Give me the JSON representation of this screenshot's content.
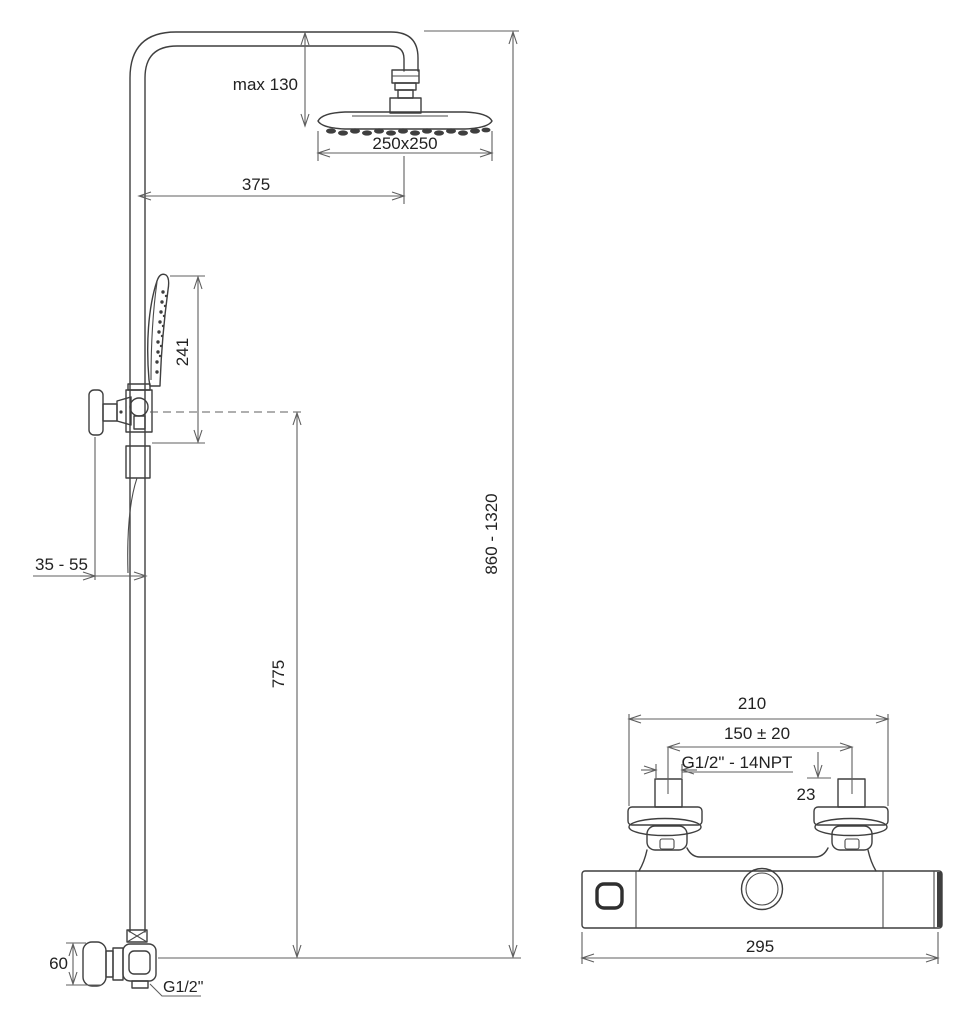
{
  "figure": {
    "type": "technical-installation-drawing",
    "subject": "thermostatic shower column with overhead shower, hand shower and wall mixer",
    "units": "mm",
    "colors": {
      "line": "#3f3f3f",
      "dimension": "#5f5f5f",
      "text": "#222222",
      "background": "#ffffff"
    }
  },
  "shower_column": {
    "max_head_offset": "max 130",
    "head_size": "250x250",
    "arm_reach": "375",
    "hand_shower_length": "241",
    "wall_distance": "35 - 55",
    "hand_shower_outlet_height": "775",
    "column_height_range": "860 - 1320",
    "elbow_height": "60",
    "outlet_thread": "G1/2\""
  },
  "mixer": {
    "overall_width": "210",
    "connection_spacing": "150 ± 20",
    "connection_thread": "G1/2\" - 14NPT",
    "thread_length": "23",
    "body_width": "295"
  }
}
